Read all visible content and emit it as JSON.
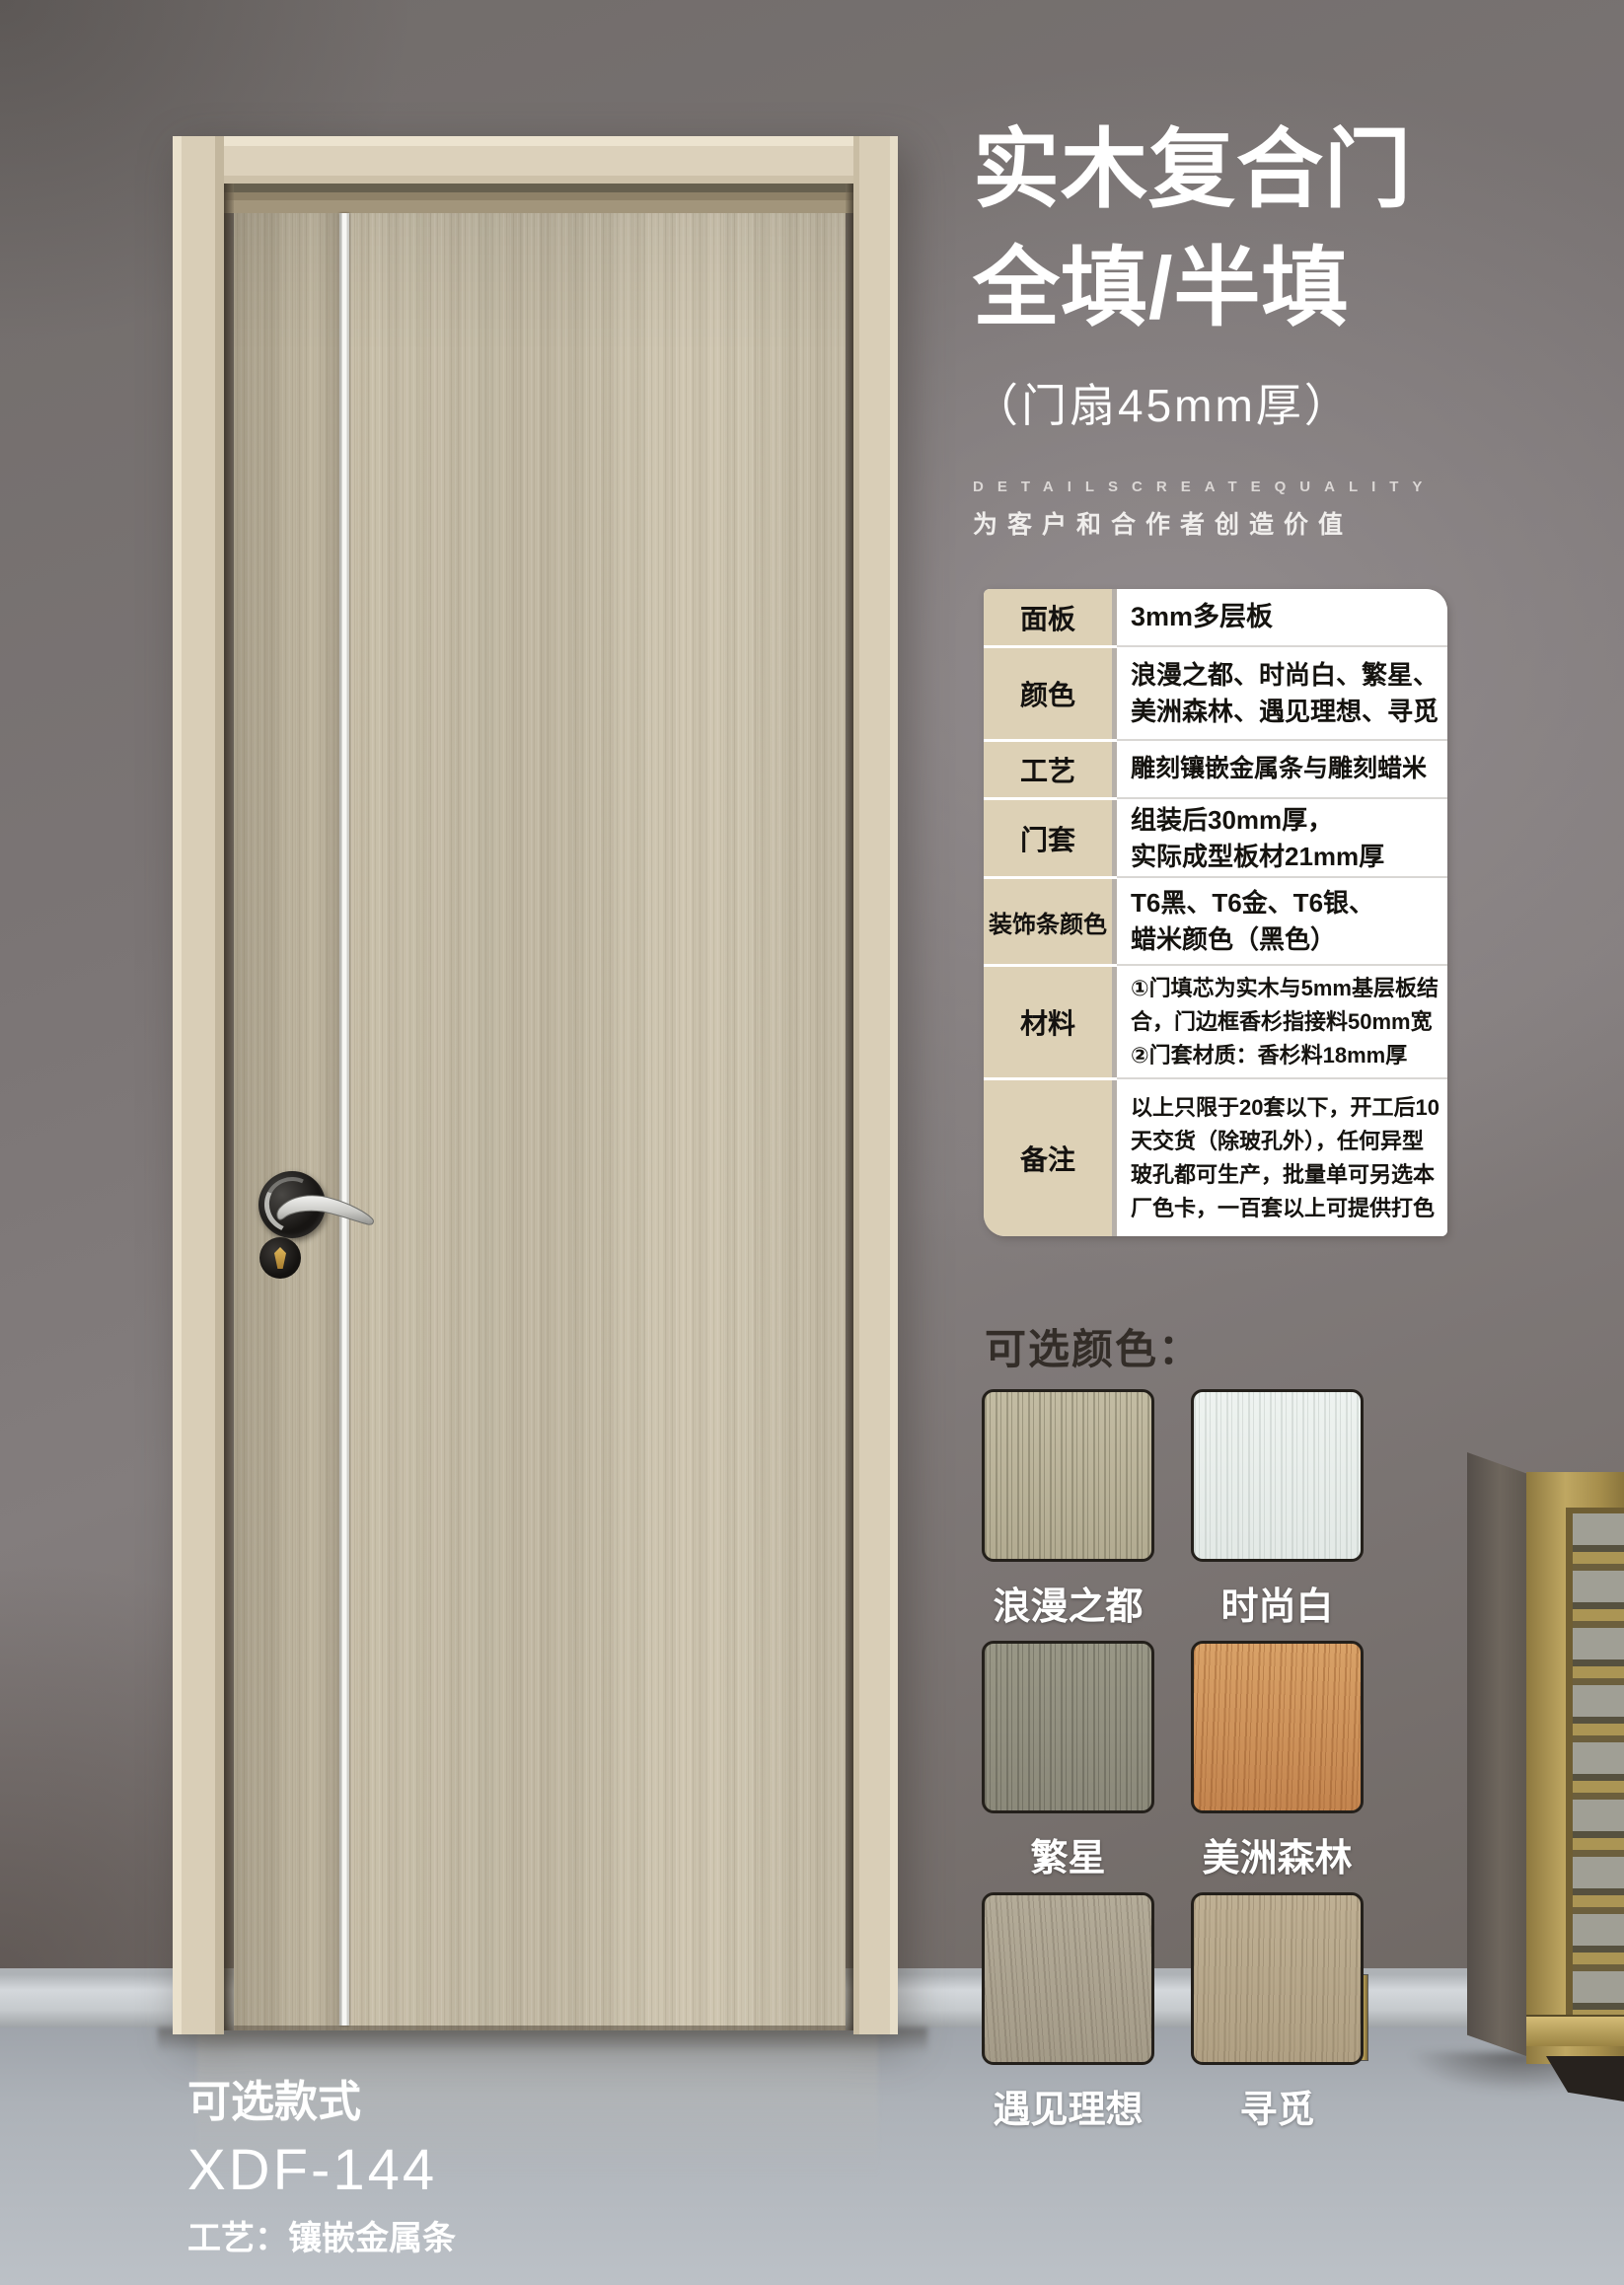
{
  "poster": {
    "title_line1": "实木复合门",
    "title_line2": "全填/半填",
    "subtitle": "（门扇45mm厚）",
    "tagline_en": "DETAILSCREATEQUALITY",
    "tagline_cn": "为客户和合作者创造价值"
  },
  "spec_table": {
    "rows": [
      {
        "label": "面板",
        "value": "3mm多层板"
      },
      {
        "label": "颜色",
        "value": "浪漫之都、时尚白、繁星、\n美洲森林、遇见理想、寻觅"
      },
      {
        "label": "工艺",
        "value": "雕刻镶嵌金属条与雕刻蜡米"
      },
      {
        "label": "门套",
        "value": "组装后30mm厚，\n实际成型板材21mm厚"
      },
      {
        "label": "装饰条颜色",
        "value": "T6黑、T6金、T6银、\n蜡米颜色（黑色）"
      },
      {
        "label": "材料",
        "value": "①门填芯为实木与5mm基层板结\n合，门边框香杉指接料50mm宽\n②门套材质：香杉料18mm厚"
      },
      {
        "label": "备注",
        "value": "以上只限于20套以下，开工后10\n天交货（除玻孔外），任何异型\n玻孔都可生产，批量单可另选本\n厂色卡，一百套以上可提供打色"
      }
    ]
  },
  "colors_section": {
    "heading": "可选颜色：",
    "swatches": [
      {
        "name": "浪漫之都",
        "base": "#b2ab91",
        "light": "#c3bca3",
        "streak": "rgba(90,85,65,0.35)",
        "angle": 90
      },
      {
        "name": "时尚白",
        "base": "#e3e9e6",
        "light": "#eef3f0",
        "streak": "rgba(160,170,165,0.28)",
        "angle": 90
      },
      {
        "name": "繁星",
        "base": "#8b897a",
        "light": "#999786",
        "streak": "rgba(60,58,48,0.30)",
        "angle": 90
      },
      {
        "name": "美洲森林",
        "base": "#c4854f",
        "light": "#d9a268",
        "streak": "rgba(140,80,35,0.38)",
        "angle": 92
      },
      {
        "name": "遇见理想",
        "base": "#a49b88",
        "light": "#b4ac99",
        "streak": "rgba(110,100,85,0.32)",
        "angle": 86
      },
      {
        "name": "寻觅",
        "base": "#b0a083",
        "light": "#bfb094",
        "streak": "rgba(120,105,80,0.32)",
        "angle": 91
      }
    ]
  },
  "style_section": {
    "heading": "可选款式",
    "model": "XDF-144",
    "craft": "工艺：镶嵌金属条"
  },
  "palette": {
    "wall": "#7b7575",
    "floor": "#b0b5bb",
    "door_wood": "#ccc3ad",
    "door_casing": "#d9ceb7",
    "metal_strip": "#f5f5f2",
    "table_label_bg": "#ddd1b6",
    "cabinet_gold": "#bfa762"
  }
}
